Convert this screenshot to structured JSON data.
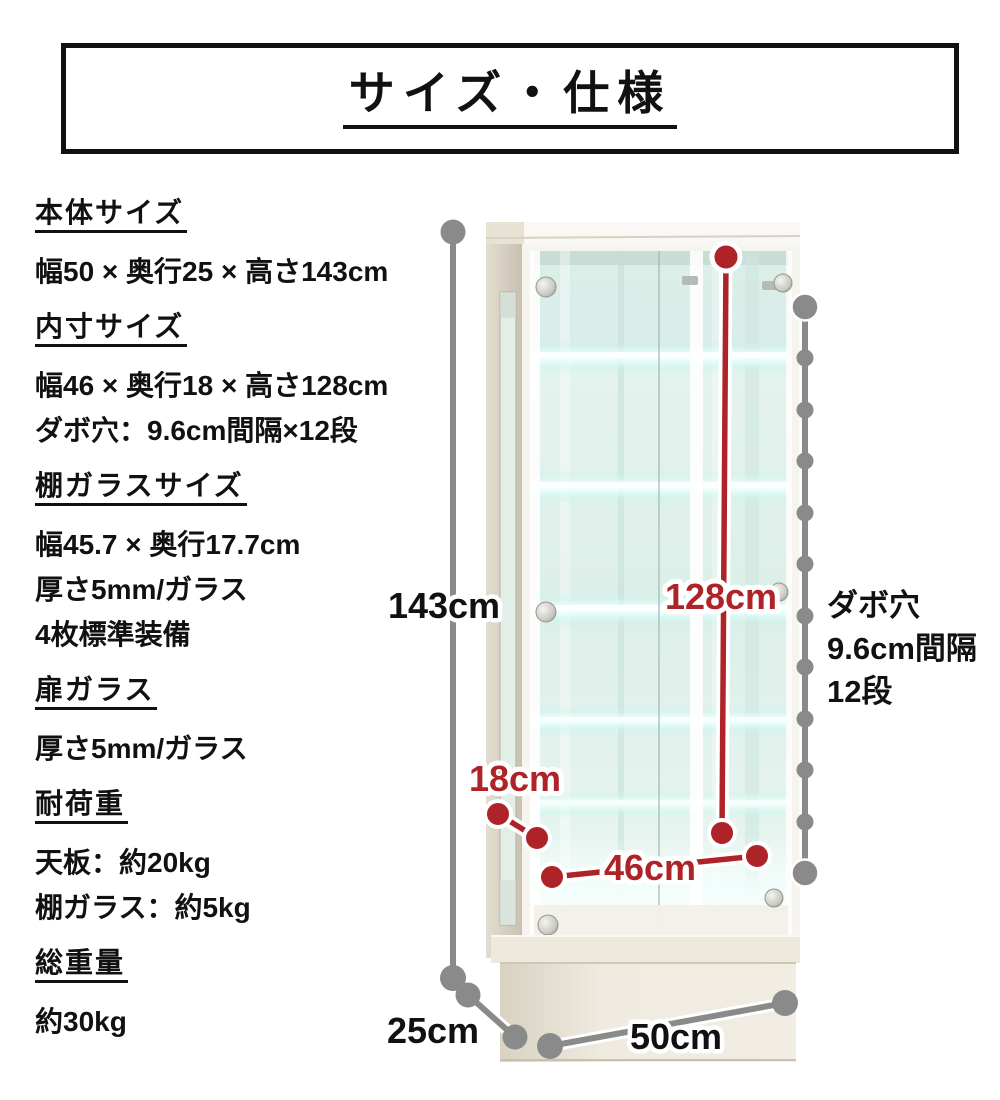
{
  "title": "サイズ・仕様",
  "specs": [
    {
      "heading": "本体サイズ",
      "lines": [
        "幅50 × 奥行25 × 高さ143cm"
      ]
    },
    {
      "heading": "内寸サイズ",
      "lines": [
        "幅46 × 奥行18 × 高さ128cm",
        "ダボ穴：9.6cm間隔×12段"
      ]
    },
    {
      "heading": "棚ガラスサイズ",
      "lines": [
        "幅45.7 × 奥行17.7cm",
        "厚さ5mm/ガラス",
        "4枚標準装備"
      ]
    },
    {
      "heading": "扉ガラス",
      "lines": [
        "厚さ5mm/ガラス"
      ]
    },
    {
      "heading": "耐荷重",
      "lines": [
        "天板：約20kg",
        "棚ガラス：約5kg"
      ]
    },
    {
      "heading": "総重量",
      "lines": [
        "約30kg"
      ]
    }
  ],
  "diagram": {
    "labels": {
      "height_total": "143cm",
      "height_inner": "128cm",
      "depth_inner": "18cm",
      "width_inner": "46cm",
      "depth_total": "25cm",
      "width_total": "50cm",
      "dabo_line1": "ダボ穴",
      "dabo_line2": "9.6cm間隔",
      "dabo_line3": "12段"
    },
    "colors": {
      "accent_red": "#ae2328",
      "accent_gray": "#8a8a8a",
      "text_black": "#111111"
    }
  }
}
